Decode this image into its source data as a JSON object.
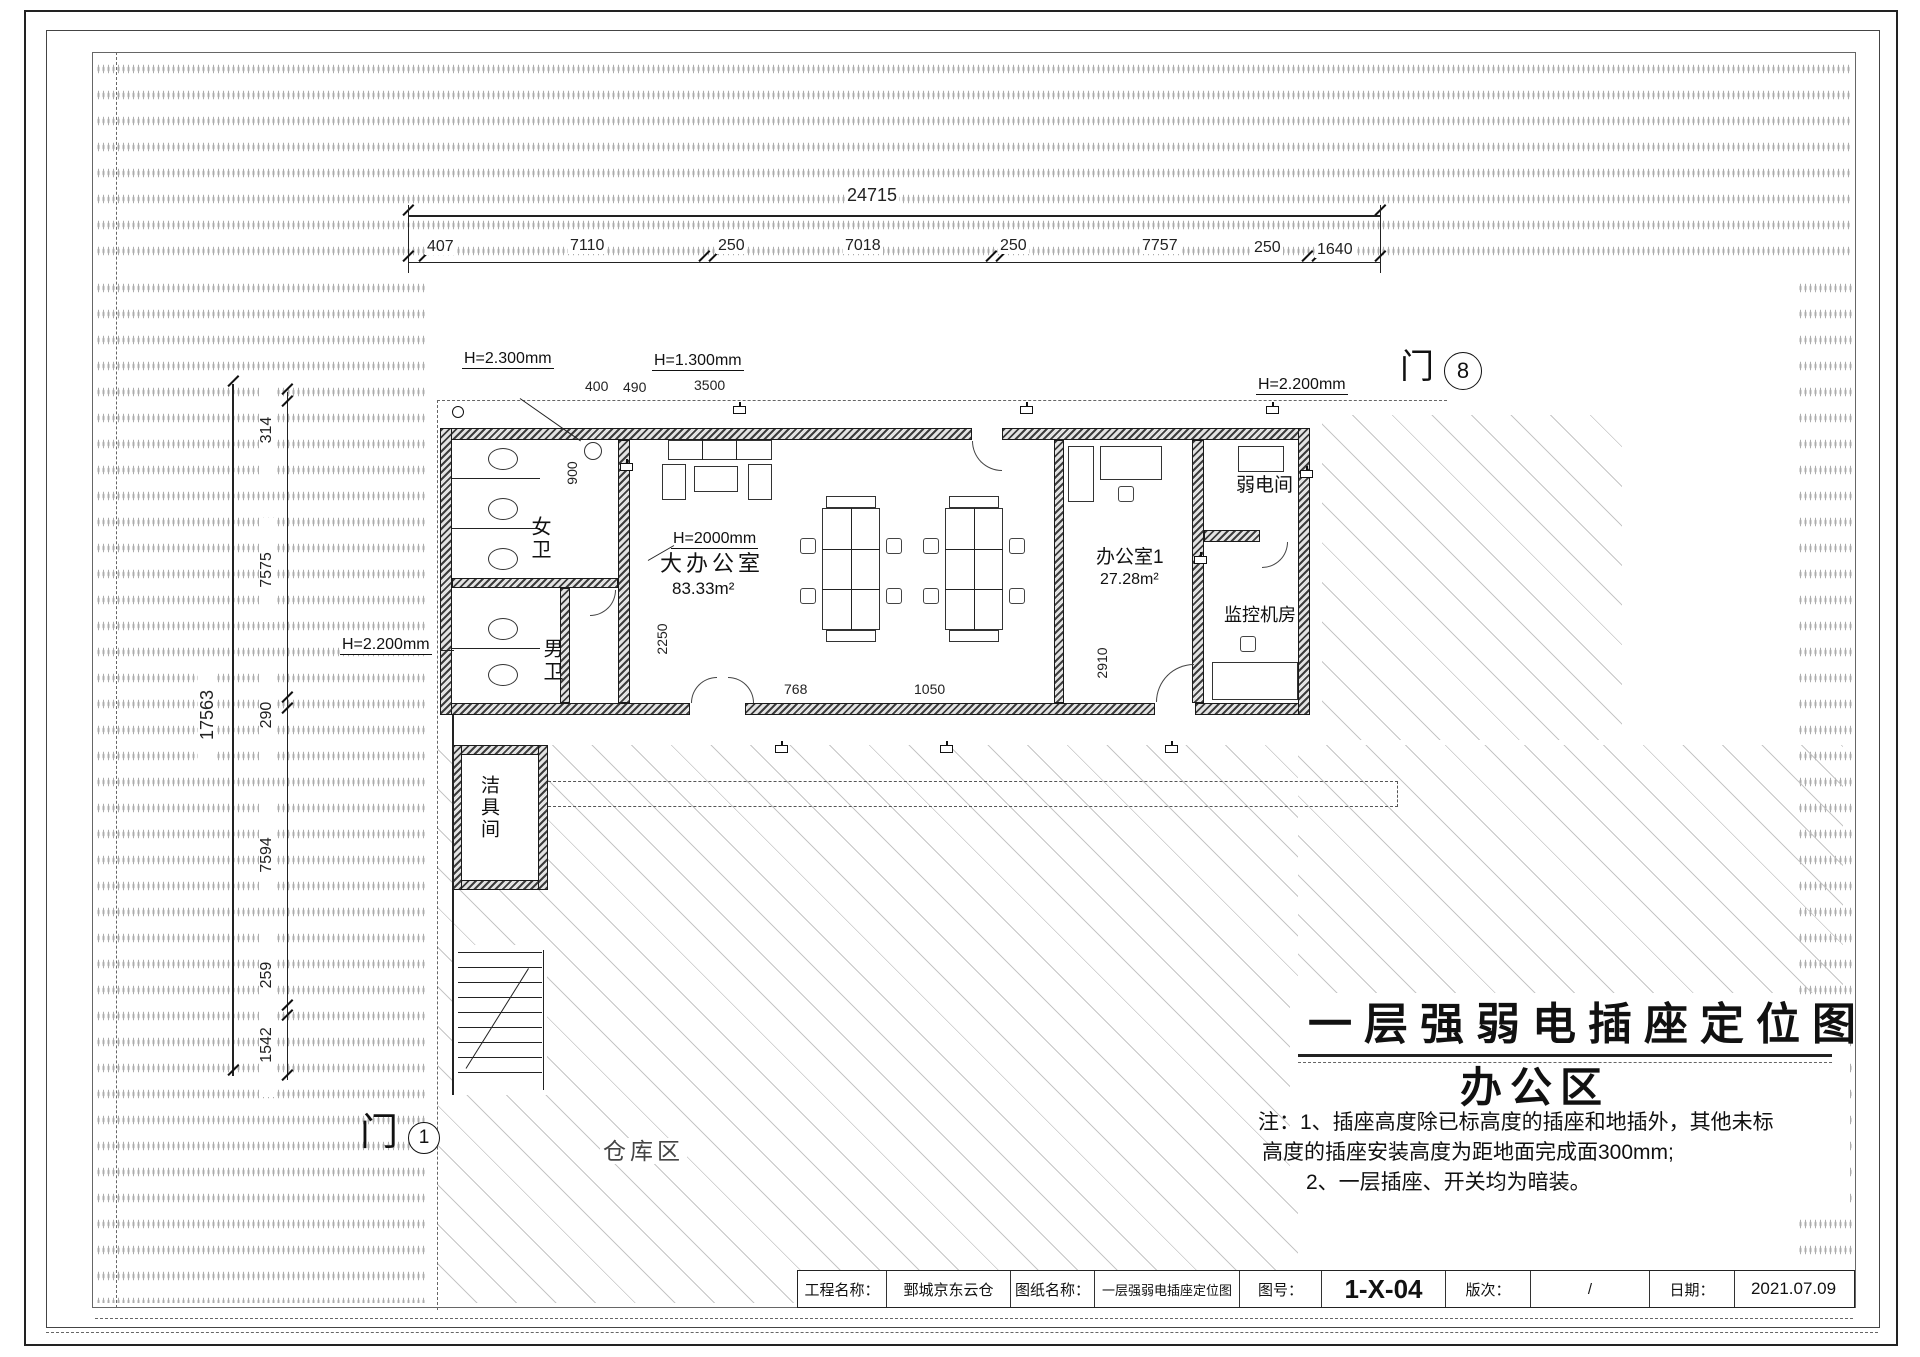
{
  "sheet": {
    "title": "一层强弱电插座定位图",
    "zone": "办公区",
    "note_line1": "注：1、插座高度除已标高度的插座和地插外，其他未标",
    "note_line2": "高度的插座安装高度为距地面完成面300mm;",
    "note_line3": "2、一层插座、开关均为暗装。"
  },
  "title_block": {
    "project_label": "工程名称：",
    "project_value": "鄄城京东云仓",
    "sheet_label": "图纸名称：",
    "sheet_value": "一层强弱电插座定位图",
    "number_label": "图号：",
    "number_value": "1-X-04",
    "revision_label": "版次：",
    "revision_value": "/",
    "date_label": "日期：",
    "date_value": "2021.07.09"
  },
  "dims": {
    "top_total": "24715",
    "top_seg": [
      "407",
      "7110",
      "250",
      "7018",
      "250",
      "7757",
      "250",
      "1640"
    ],
    "left_total": "17563",
    "left_seg": [
      "314",
      "7575",
      "290",
      "7594",
      "259",
      "1542"
    ],
    "d400": "400",
    "d490": "490",
    "d3500": "3500",
    "d900": "900",
    "d2250": "2250",
    "d2910": "2910",
    "d768": "768",
    "d1050": "1050"
  },
  "rooms": {
    "womens_wc": "女卫",
    "mens_wc": "男卫",
    "main_office": "大办公室",
    "main_office_area": "83.33m²",
    "office1": "办公室1",
    "office1_area": "27.28m²",
    "low_voltage_room": "弱电间",
    "monitor_room": "监控机房",
    "janitor_room": "洁具间",
    "warehouse_zone": "仓库区"
  },
  "heights": {
    "h2300": "H=2.300mm",
    "h1300": "H=1.300mm",
    "h2200_right": "H=2.200mm",
    "h2200_left": "H=2.200mm",
    "h2000": "H=2000mm"
  },
  "marks": {
    "door_char_bottom": "门",
    "door_num_bottom": "1",
    "door_char_top": "门",
    "axis_bubble_top": "8"
  }
}
